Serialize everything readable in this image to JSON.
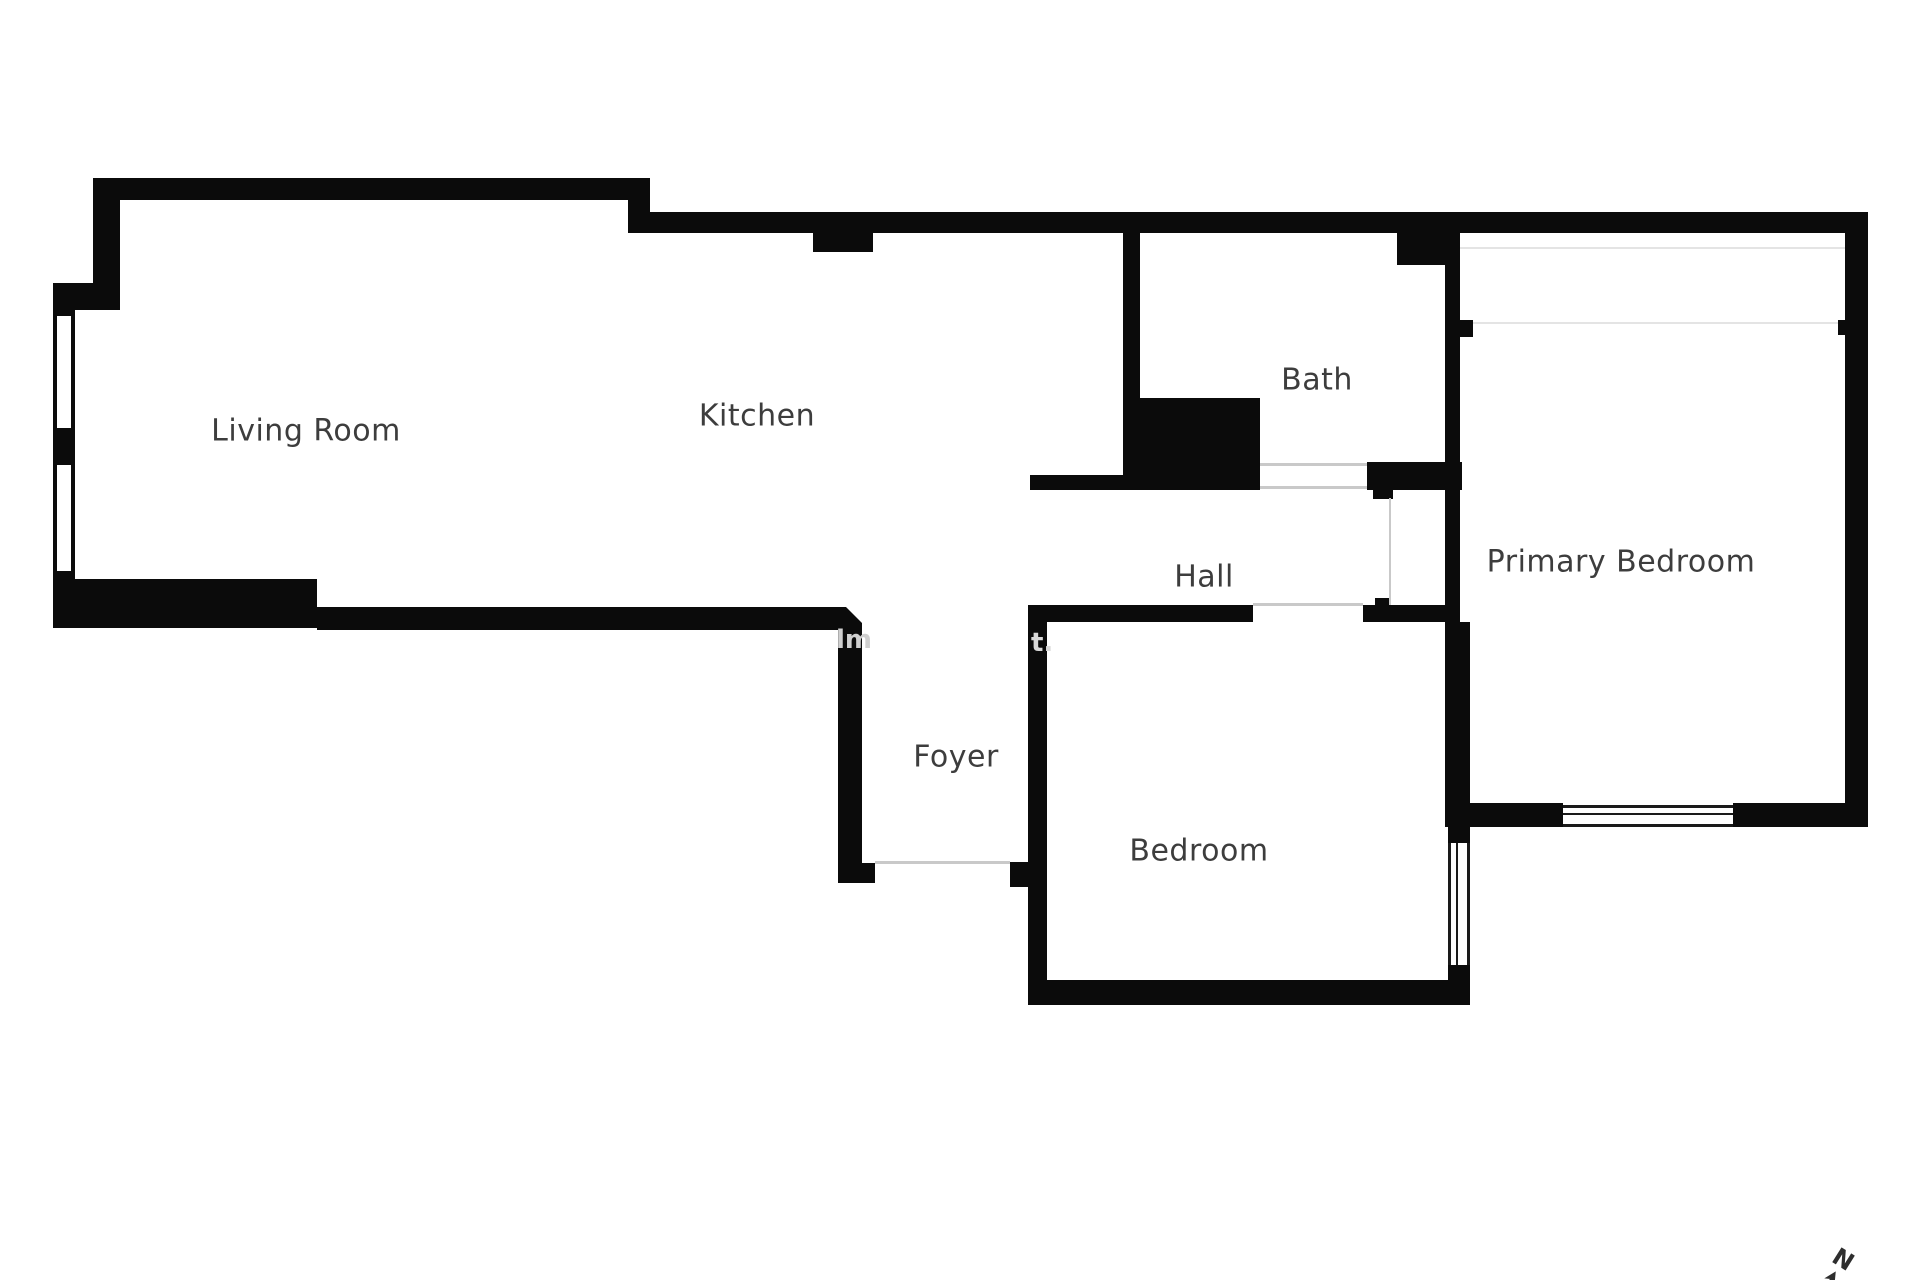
{
  "figure": {
    "kind": "apartment floor plan"
  },
  "rooms": [
    {
      "name": "Living Room"
    },
    {
      "name": "Kitchen"
    },
    {
      "name": "Bath"
    },
    {
      "name": "Hall"
    },
    {
      "name": "Primary Bedroom"
    },
    {
      "name": "Foyer"
    },
    {
      "name": "Bedroom"
    }
  ],
  "watermark": {
    "fragments": [
      "lm",
      "t."
    ]
  },
  "compass": {
    "label": "N"
  },
  "colors": {
    "wall": "#0b0b0b",
    "label_text": "#3d3d3d",
    "threshold_line": "#c9c9c9",
    "faint_line": "#e4e4e4",
    "watermark_text": "#cfcfcf",
    "background": "#ffffff"
  }
}
